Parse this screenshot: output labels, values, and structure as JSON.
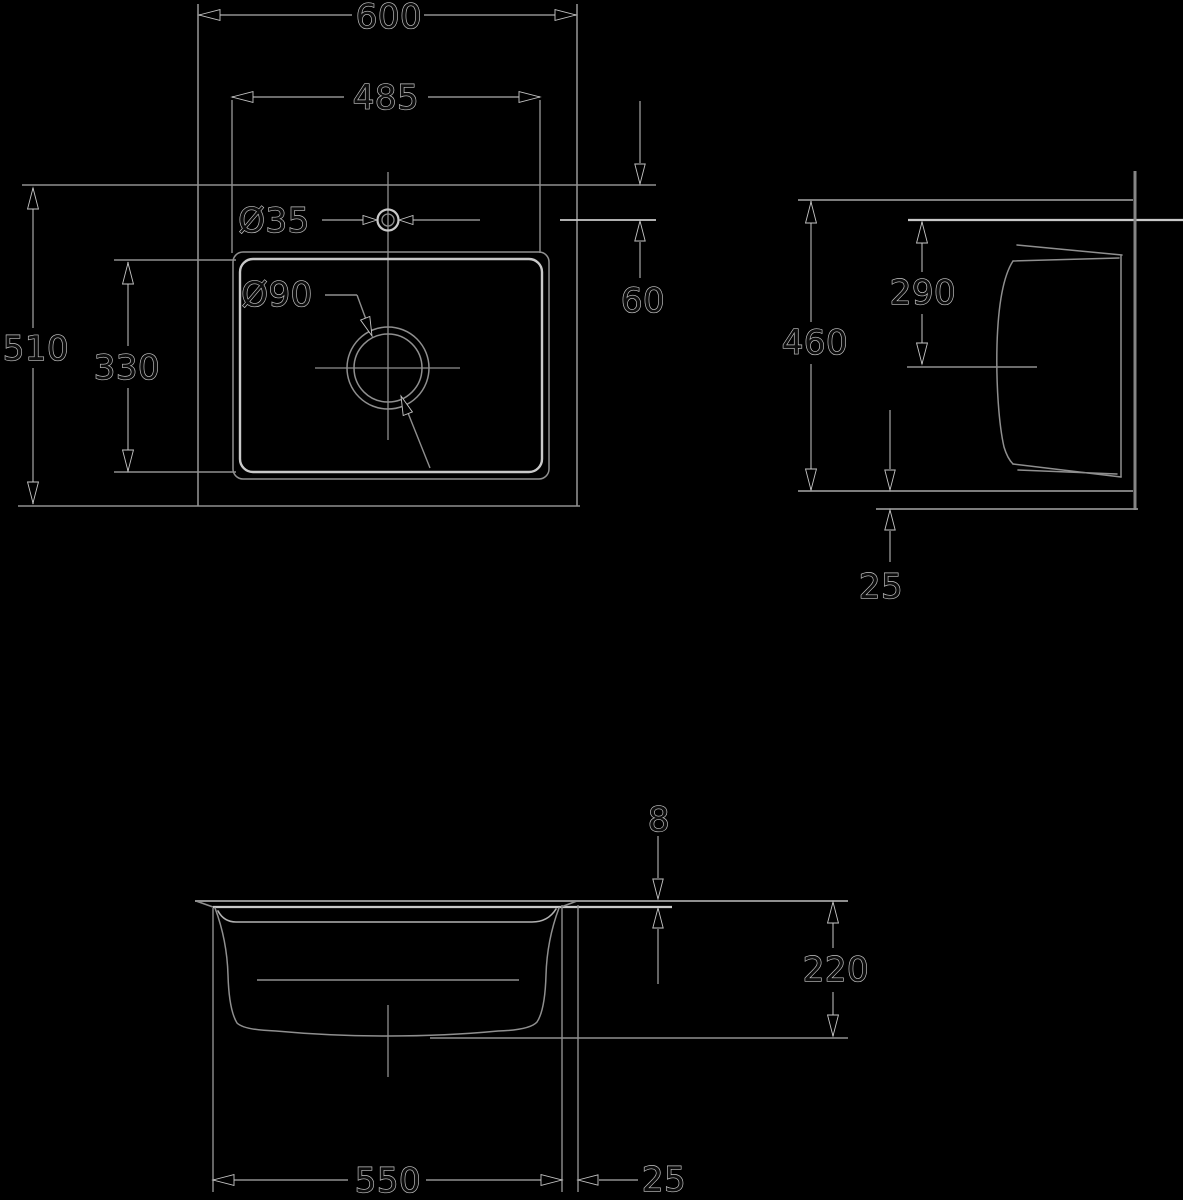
{
  "canvas": {
    "width": 1183,
    "height": 1200,
    "background": "#000000"
  },
  "styles": {
    "strokes": {
      "line": "#8f8f8f",
      "bright": "#c9c9c9",
      "mid": "#b2b2b2",
      "thick": "#858585"
    },
    "arrow_fill": "#000000",
    "halo": "#c6c6c6",
    "text_fill": "#0c0c0c",
    "font_size": 34
  },
  "dimensions_summary": {
    "plan_view": [
      "600",
      "485",
      "510",
      "330",
      "Ø35",
      "Ø90",
      "60"
    ],
    "side_view": [
      "460",
      "290",
      "25"
    ],
    "front_view": [
      "8",
      "220",
      "550",
      "25"
    ]
  },
  "drawing": {
    "lines": [
      {
        "name": "plan-outer-left-edge",
        "x1": 198,
        "y1": 4,
        "x2": 198,
        "y2": 506,
        "s": "line",
        "w": 1.6
      },
      {
        "name": "plan-outer-right-edge",
        "x1": 577,
        "y1": 4,
        "x2": 577,
        "y2": 506,
        "s": "line",
        "w": 1.6
      },
      {
        "name": "plan-outer-top-edge",
        "x1": 22,
        "y1": 185,
        "x2": 656,
        "y2": 185,
        "s": "line",
        "w": 1.6
      },
      {
        "name": "plan-outer-bottom-edge",
        "x1": 18,
        "y1": 506,
        "x2": 580,
        "y2": 506,
        "s": "line",
        "w": 1.6
      },
      {
        "name": "dim-600-line-left",
        "x1": 199,
        "y1": 15,
        "x2": 352,
        "y2": 15,
        "s": "line",
        "w": 1.4
      },
      {
        "name": "dim-600-line-right",
        "x1": 424,
        "y1": 15,
        "x2": 576,
        "y2": 15,
        "s": "line",
        "w": 1.4
      },
      {
        "name": "dim-485-ext-left",
        "x1": 232,
        "y1": 100,
        "x2": 232,
        "y2": 253,
        "s": "line",
        "w": 1.4
      },
      {
        "name": "dim-485-ext-right",
        "x1": 540,
        "y1": 100,
        "x2": 540,
        "y2": 253,
        "s": "line",
        "w": 1.4
      },
      {
        "name": "dim-485-line-left",
        "x1": 232,
        "y1": 97,
        "x2": 344,
        "y2": 97,
        "s": "line",
        "w": 1.4
      },
      {
        "name": "dim-485-line-right",
        "x1": 428,
        "y1": 97,
        "x2": 540,
        "y2": 97,
        "s": "line",
        "w": 1.4
      },
      {
        "name": "dim-510-line-top",
        "x1": 33,
        "y1": 188,
        "x2": 33,
        "y2": 328,
        "s": "line",
        "w": 1.4
      },
      {
        "name": "dim-510-line-bottom",
        "x1": 33,
        "y1": 368,
        "x2": 33,
        "y2": 504,
        "s": "line",
        "w": 1.4
      },
      {
        "name": "dim-330-line-top",
        "x1": 128,
        "y1": 262,
        "x2": 128,
        "y2": 346,
        "s": "line",
        "w": 1.4
      },
      {
        "name": "dim-330-line-bottom",
        "x1": 128,
        "y1": 388,
        "x2": 128,
        "y2": 472,
        "s": "line",
        "w": 1.4
      },
      {
        "name": "dim-330-ext-top",
        "x1": 114,
        "y1": 260,
        "x2": 236,
        "y2": 260,
        "s": "line",
        "w": 1.4
      },
      {
        "name": "dim-330-ext-bottom",
        "x1": 114,
        "y1": 472,
        "x2": 236,
        "y2": 472,
        "s": "line",
        "w": 1.4
      },
      {
        "name": "faucet-centerline-h-left",
        "x1": 322,
        "y1": 220,
        "x2": 371,
        "y2": 220,
        "s": "line",
        "w": 1.4
      },
      {
        "name": "faucet-centerline-h-right",
        "x1": 405,
        "y1": 220,
        "x2": 480,
        "y2": 220,
        "s": "line",
        "w": 1.4
      },
      {
        "name": "dim-60-ext-centerline",
        "x1": 560,
        "y1": 220,
        "x2": 656,
        "y2": 220,
        "s": "bright",
        "w": 1.8
      },
      {
        "name": "plan-vertical-centerline",
        "x1": 388,
        "y1": 172,
        "x2": 388,
        "y2": 440,
        "s": "line",
        "w": 1.3
      },
      {
        "name": "drain-centerline-h",
        "x1": 315,
        "y1": 368,
        "x2": 460,
        "y2": 368,
        "s": "line",
        "w": 1.3
      },
      {
        "name": "dim-60-line-top",
        "x1": 640,
        "y1": 101,
        "x2": 640,
        "y2": 163,
        "s": "line",
        "w": 1.4
      },
      {
        "name": "dim-60-line-bottom",
        "x1": 640,
        "y1": 242,
        "x2": 640,
        "y2": 278,
        "s": "line",
        "w": 1.4
      },
      {
        "name": "dia90-leader-h",
        "x1": 325,
        "y1": 295,
        "x2": 357,
        "y2": 295,
        "s": "line",
        "w": 1.4
      },
      {
        "name": "dia90-leader-diag",
        "x1": 357,
        "y1": 295,
        "x2": 371,
        "y2": 333,
        "s": "line",
        "w": 1.4
      },
      {
        "name": "dia90-tail",
        "x1": 402,
        "y1": 398,
        "x2": 430,
        "y2": 468,
        "s": "line",
        "w": 1.4
      },
      {
        "name": "side-top-line",
        "x1": 798,
        "y1": 200,
        "x2": 1133,
        "y2": 200,
        "s": "line",
        "w": 1.8
      },
      {
        "name": "side-counter-line",
        "x1": 908,
        "y1": 220,
        "x2": 1183,
        "y2": 220,
        "s": "bright",
        "w": 2.2
      },
      {
        "name": "side-right-vertical",
        "x1": 1135,
        "y1": 171,
        "x2": 1135,
        "y2": 510,
        "s": "thick",
        "w": 3
      },
      {
        "name": "dim-460-line-top",
        "x1": 811,
        "y1": 201,
        "x2": 811,
        "y2": 322,
        "s": "line",
        "w": 1.4
      },
      {
        "name": "dim-460-line-bottom",
        "x1": 811,
        "y1": 364,
        "x2": 811,
        "y2": 490,
        "s": "line",
        "w": 1.4
      },
      {
        "name": "dim-290-line-top",
        "x1": 922,
        "y1": 222,
        "x2": 922,
        "y2": 272,
        "s": "line",
        "w": 1.4
      },
      {
        "name": "dim-290-line-bottom",
        "x1": 922,
        "y1": 314,
        "x2": 922,
        "y2": 364,
        "s": "line",
        "w": 1.4
      },
      {
        "name": "side-centerline",
        "x1": 907,
        "y1": 367,
        "x2": 1037,
        "y2": 367,
        "s": "line",
        "w": 1.4
      },
      {
        "name": "side-bottom-line",
        "x1": 798,
        "y1": 491,
        "x2": 1133,
        "y2": 491,
        "s": "line",
        "w": 1.8
      },
      {
        "name": "side-bottom-offset-line",
        "x1": 876,
        "y1": 509,
        "x2": 1138,
        "y2": 509,
        "s": "line",
        "w": 1.8
      },
      {
        "name": "dim-25side-line-top",
        "x1": 890,
        "y1": 410,
        "x2": 890,
        "y2": 469,
        "s": "line",
        "w": 1.4
      },
      {
        "name": "dim-25side-line-bottom",
        "x1": 890,
        "y1": 531,
        "x2": 890,
        "y2": 562,
        "s": "line",
        "w": 1.4
      },
      {
        "name": "front-top-line",
        "x1": 195,
        "y1": 901,
        "x2": 848,
        "y2": 901,
        "s": "line",
        "w": 2
      },
      {
        "name": "front-rim-underside",
        "x1": 213,
        "y1": 907,
        "x2": 672,
        "y2": 907,
        "s": "bright",
        "w": 2.2
      },
      {
        "name": "front-rim-bevel-left",
        "x1": 196,
        "y1": 901,
        "x2": 213,
        "y2": 907,
        "s": "line",
        "w": 1.5
      },
      {
        "name": "front-rim-bevel-right",
        "x1": 577,
        "y1": 901,
        "x2": 561,
        "y2": 907,
        "s": "line",
        "w": 1.5
      },
      {
        "name": "dim-8-line-top",
        "x1": 658,
        "y1": 836,
        "x2": 658,
        "y2": 878,
        "s": "line",
        "w": 1.4
      },
      {
        "name": "dim-8-line-bottom",
        "x1": 658,
        "y1": 929,
        "x2": 658,
        "y2": 984,
        "s": "line",
        "w": 1.4
      },
      {
        "name": "dim-220-line-top",
        "x1": 833,
        "y1": 903,
        "x2": 833,
        "y2": 948,
        "s": "line",
        "w": 1.4
      },
      {
        "name": "dim-220-line-bottom",
        "x1": 833,
        "y1": 992,
        "x2": 833,
        "y2": 1036,
        "s": "line",
        "w": 1.4
      },
      {
        "name": "front-bottom-ext-line",
        "x1": 430,
        "y1": 1038,
        "x2": 848,
        "y2": 1038,
        "s": "line",
        "w": 1.6
      },
      {
        "name": "front-ext-left",
        "x1": 213,
        "y1": 908,
        "x2": 213,
        "y2": 1192,
        "s": "line",
        "w": 1.4
      },
      {
        "name": "front-ext-bowl-right",
        "x1": 562,
        "y1": 905,
        "x2": 562,
        "y2": 1192,
        "s": "line",
        "w": 1.4
      },
      {
        "name": "front-ext-rim-right",
        "x1": 578,
        "y1": 905,
        "x2": 578,
        "y2": 1192,
        "s": "line",
        "w": 1.4
      },
      {
        "name": "dim-550-line-left",
        "x1": 213,
        "y1": 1180,
        "x2": 348,
        "y2": 1180,
        "s": "line",
        "w": 1.4
      },
      {
        "name": "dim-550-line-right",
        "x1": 426,
        "y1": 1180,
        "x2": 562,
        "y2": 1180,
        "s": "line",
        "w": 1.4
      },
      {
        "name": "dim-25b-line",
        "x1": 599,
        "y1": 1180,
        "x2": 638,
        "y2": 1180,
        "s": "line",
        "w": 1.4
      },
      {
        "name": "front-drain-centerline",
        "x1": 388,
        "y1": 1005,
        "x2": 388,
        "y2": 1077,
        "s": "line",
        "w": 1.3
      },
      {
        "name": "front-far-bottom-line",
        "x1": 257,
        "y1": 980,
        "x2": 519,
        "y2": 980,
        "s": "line",
        "w": 1.4
      }
    ],
    "rects": [
      {
        "name": "plan-bowl-outer",
        "x": 233,
        "y": 252,
        "w": 316,
        "h": 227,
        "r": 10,
        "s": "line",
        "sw": 1.5
      },
      {
        "name": "plan-bowl-inner",
        "x": 240,
        "y": 259,
        "w": 302,
        "h": 213,
        "r": 13,
        "s": "bright",
        "sw": 2.4
      }
    ],
    "circles": [
      {
        "name": "faucet-hole-outer",
        "cx": 388,
        "cy": 220,
        "r": 10.5,
        "s": "bright",
        "sw": 2.2
      },
      {
        "name": "faucet-hole-inner",
        "cx": 388,
        "cy": 220,
        "r": 6,
        "s": "line",
        "sw": 1.3
      },
      {
        "name": "drain-circle-outer",
        "cx": 388,
        "cy": 368,
        "r": 41,
        "s": "line",
        "sw": 1.5
      },
      {
        "name": "drain-circle-inner",
        "cx": 388,
        "cy": 368,
        "r": 34,
        "s": "line",
        "sw": 1.5
      }
    ],
    "paths": [
      {
        "name": "side-bowl-rim-top-outer",
        "d": "M1017,245 L1122,255",
        "s": "line",
        "sw": 1.5
      },
      {
        "name": "side-bowl-rim-top-inner",
        "d": "M1013,261 L1119,258",
        "s": "line",
        "sw": 1.5
      },
      {
        "name": "side-bowl-right-edge",
        "d": "M1121,256 L1121,477",
        "s": "line",
        "sw": 1.5
      },
      {
        "name": "side-bowl-rim-bottom-outer",
        "d": "M1013,464 L1121,477",
        "s": "line",
        "sw": 1.5
      },
      {
        "name": "side-bowl-rim-bottom-inner",
        "d": "M1018,470 L1117,474",
        "s": "line",
        "sw": 1.5
      },
      {
        "name": "side-bowl-left-wall",
        "d": "M1013,261 C1002,278 998,310 997,345 C996,385 999,425 1004,447 C1007,457 1010,461 1013,464",
        "s": "line",
        "sw": 1.5
      },
      {
        "name": "front-bowl-outline",
        "d": "M215,908 Q227,940 228,975 Q229,1010 237,1023 Q244,1030 276,1031 Q330,1036 388,1036 Q446,1036 498,1031 Q530,1030 537,1022 Q545,1010 546,975 Q547,940 559,908",
        "s": "line",
        "sw": 1.5
      },
      {
        "name": "front-bowl-inner-rim",
        "d": "M218,911 Q224,922 236,922 L532,922 Q548,922 556,909",
        "s": "mid",
        "sw": 1.6
      }
    ],
    "arrows": [
      {
        "name": "dim-600-arrow-left",
        "x": 199,
        "y": 15,
        "a": 180,
        "len": 21
      },
      {
        "name": "dim-600-arrow-right",
        "x": 576,
        "y": 15,
        "a": 0,
        "len": 21
      },
      {
        "name": "dim-485-arrow-left",
        "x": 232,
        "y": 97,
        "a": 180,
        "len": 21
      },
      {
        "name": "dim-485-arrow-right",
        "x": 540,
        "y": 97,
        "a": 0,
        "len": 21
      },
      {
        "name": "dim-510-arrow-top",
        "x": 33,
        "y": 188,
        "a": 270,
        "len": 21
      },
      {
        "name": "dim-510-arrow-bottom",
        "x": 33,
        "y": 503,
        "a": 90,
        "len": 21
      },
      {
        "name": "dim-330-arrow-top",
        "x": 128,
        "y": 263,
        "a": 270,
        "len": 21
      },
      {
        "name": "dim-330-arrow-bottom",
        "x": 128,
        "y": 471,
        "a": 90,
        "len": 21
      },
      {
        "name": "dim-35-arrow-left",
        "x": 377,
        "y": 220,
        "a": 0,
        "len": 14
      },
      {
        "name": "dim-35-arrow-right",
        "x": 399,
        "y": 220,
        "a": 180,
        "len": 14
      },
      {
        "name": "dim-60-arrow-upper",
        "x": 640,
        "y": 184,
        "a": 90,
        "len": 20
      },
      {
        "name": "dim-60-arrow-lower",
        "x": 640,
        "y": 221,
        "a": 270,
        "len": 20
      },
      {
        "name": "dia90-arrow-upper",
        "x": 372,
        "y": 336,
        "a": 69,
        "len": 19
      },
      {
        "name": "dia90-arrow-lower",
        "x": 401,
        "y": 396,
        "a": 249,
        "len": 19
      },
      {
        "name": "dim-460-arrow-top",
        "x": 811,
        "y": 202,
        "a": 270,
        "len": 21
      },
      {
        "name": "dim-460-arrow-bottom",
        "x": 811,
        "y": 490,
        "a": 90,
        "len": 21
      },
      {
        "name": "dim-290-arrow-top",
        "x": 922,
        "y": 222,
        "a": 270,
        "len": 21
      },
      {
        "name": "dim-290-arrow-bottom",
        "x": 922,
        "y": 364,
        "a": 90,
        "len": 21
      },
      {
        "name": "dim-25side-arrow-upper",
        "x": 890,
        "y": 490,
        "a": 90,
        "len": 20
      },
      {
        "name": "dim-25side-arrow-lower",
        "x": 890,
        "y": 510,
        "a": 270,
        "len": 20
      },
      {
        "name": "dim-8-arrow-upper",
        "x": 658,
        "y": 899,
        "a": 90,
        "len": 20
      },
      {
        "name": "dim-8-arrow-lower",
        "x": 658,
        "y": 908,
        "a": 270,
        "len": 20
      },
      {
        "name": "dim-220-arrow-top",
        "x": 833,
        "y": 902,
        "a": 270,
        "len": 21
      },
      {
        "name": "dim-220-arrow-bottom",
        "x": 833,
        "y": 1036,
        "a": 90,
        "len": 21
      },
      {
        "name": "dim-550-arrow-left",
        "x": 213,
        "y": 1180,
        "a": 180,
        "len": 21
      },
      {
        "name": "dim-550-arrow-right",
        "x": 562,
        "y": 1180,
        "a": 0,
        "len": 21
      },
      {
        "name": "dim-25b-arrow",
        "x": 578,
        "y": 1180,
        "a": 180,
        "len": 20
      }
    ],
    "labels": [
      {
        "name": "dim-600-label",
        "text": "600",
        "x": 389,
        "y": 17
      },
      {
        "name": "dim-485-label",
        "text": "485",
        "x": 386,
        "y": 98
      },
      {
        "name": "dim-510-label",
        "text": "510",
        "x": 36,
        "y": 349
      },
      {
        "name": "dim-330-label",
        "text": "330",
        "x": 127,
        "y": 368
      },
      {
        "name": "dia-35-label",
        "text": "Ø35",
        "x": 274,
        "y": 221
      },
      {
        "name": "dia-90-label",
        "text": "Ø90",
        "x": 277,
        "y": 295
      },
      {
        "name": "dim-60-label",
        "text": "60",
        "x": 643,
        "y": 301
      },
      {
        "name": "dim-460-label",
        "text": "460",
        "x": 815,
        "y": 343
      },
      {
        "name": "dim-290-label",
        "text": "290",
        "x": 923,
        "y": 293
      },
      {
        "name": "dim-25side-label",
        "text": "25",
        "x": 881,
        "y": 587
      },
      {
        "name": "dim-8-label",
        "text": "8",
        "x": 659,
        "y": 820
      },
      {
        "name": "dim-220-label",
        "text": "220",
        "x": 836,
        "y": 970
      },
      {
        "name": "dim-550-label",
        "text": "550",
        "x": 388,
        "y": 1181
      },
      {
        "name": "dim-25b-label",
        "text": "25",
        "x": 664,
        "y": 1180
      }
    ]
  }
}
